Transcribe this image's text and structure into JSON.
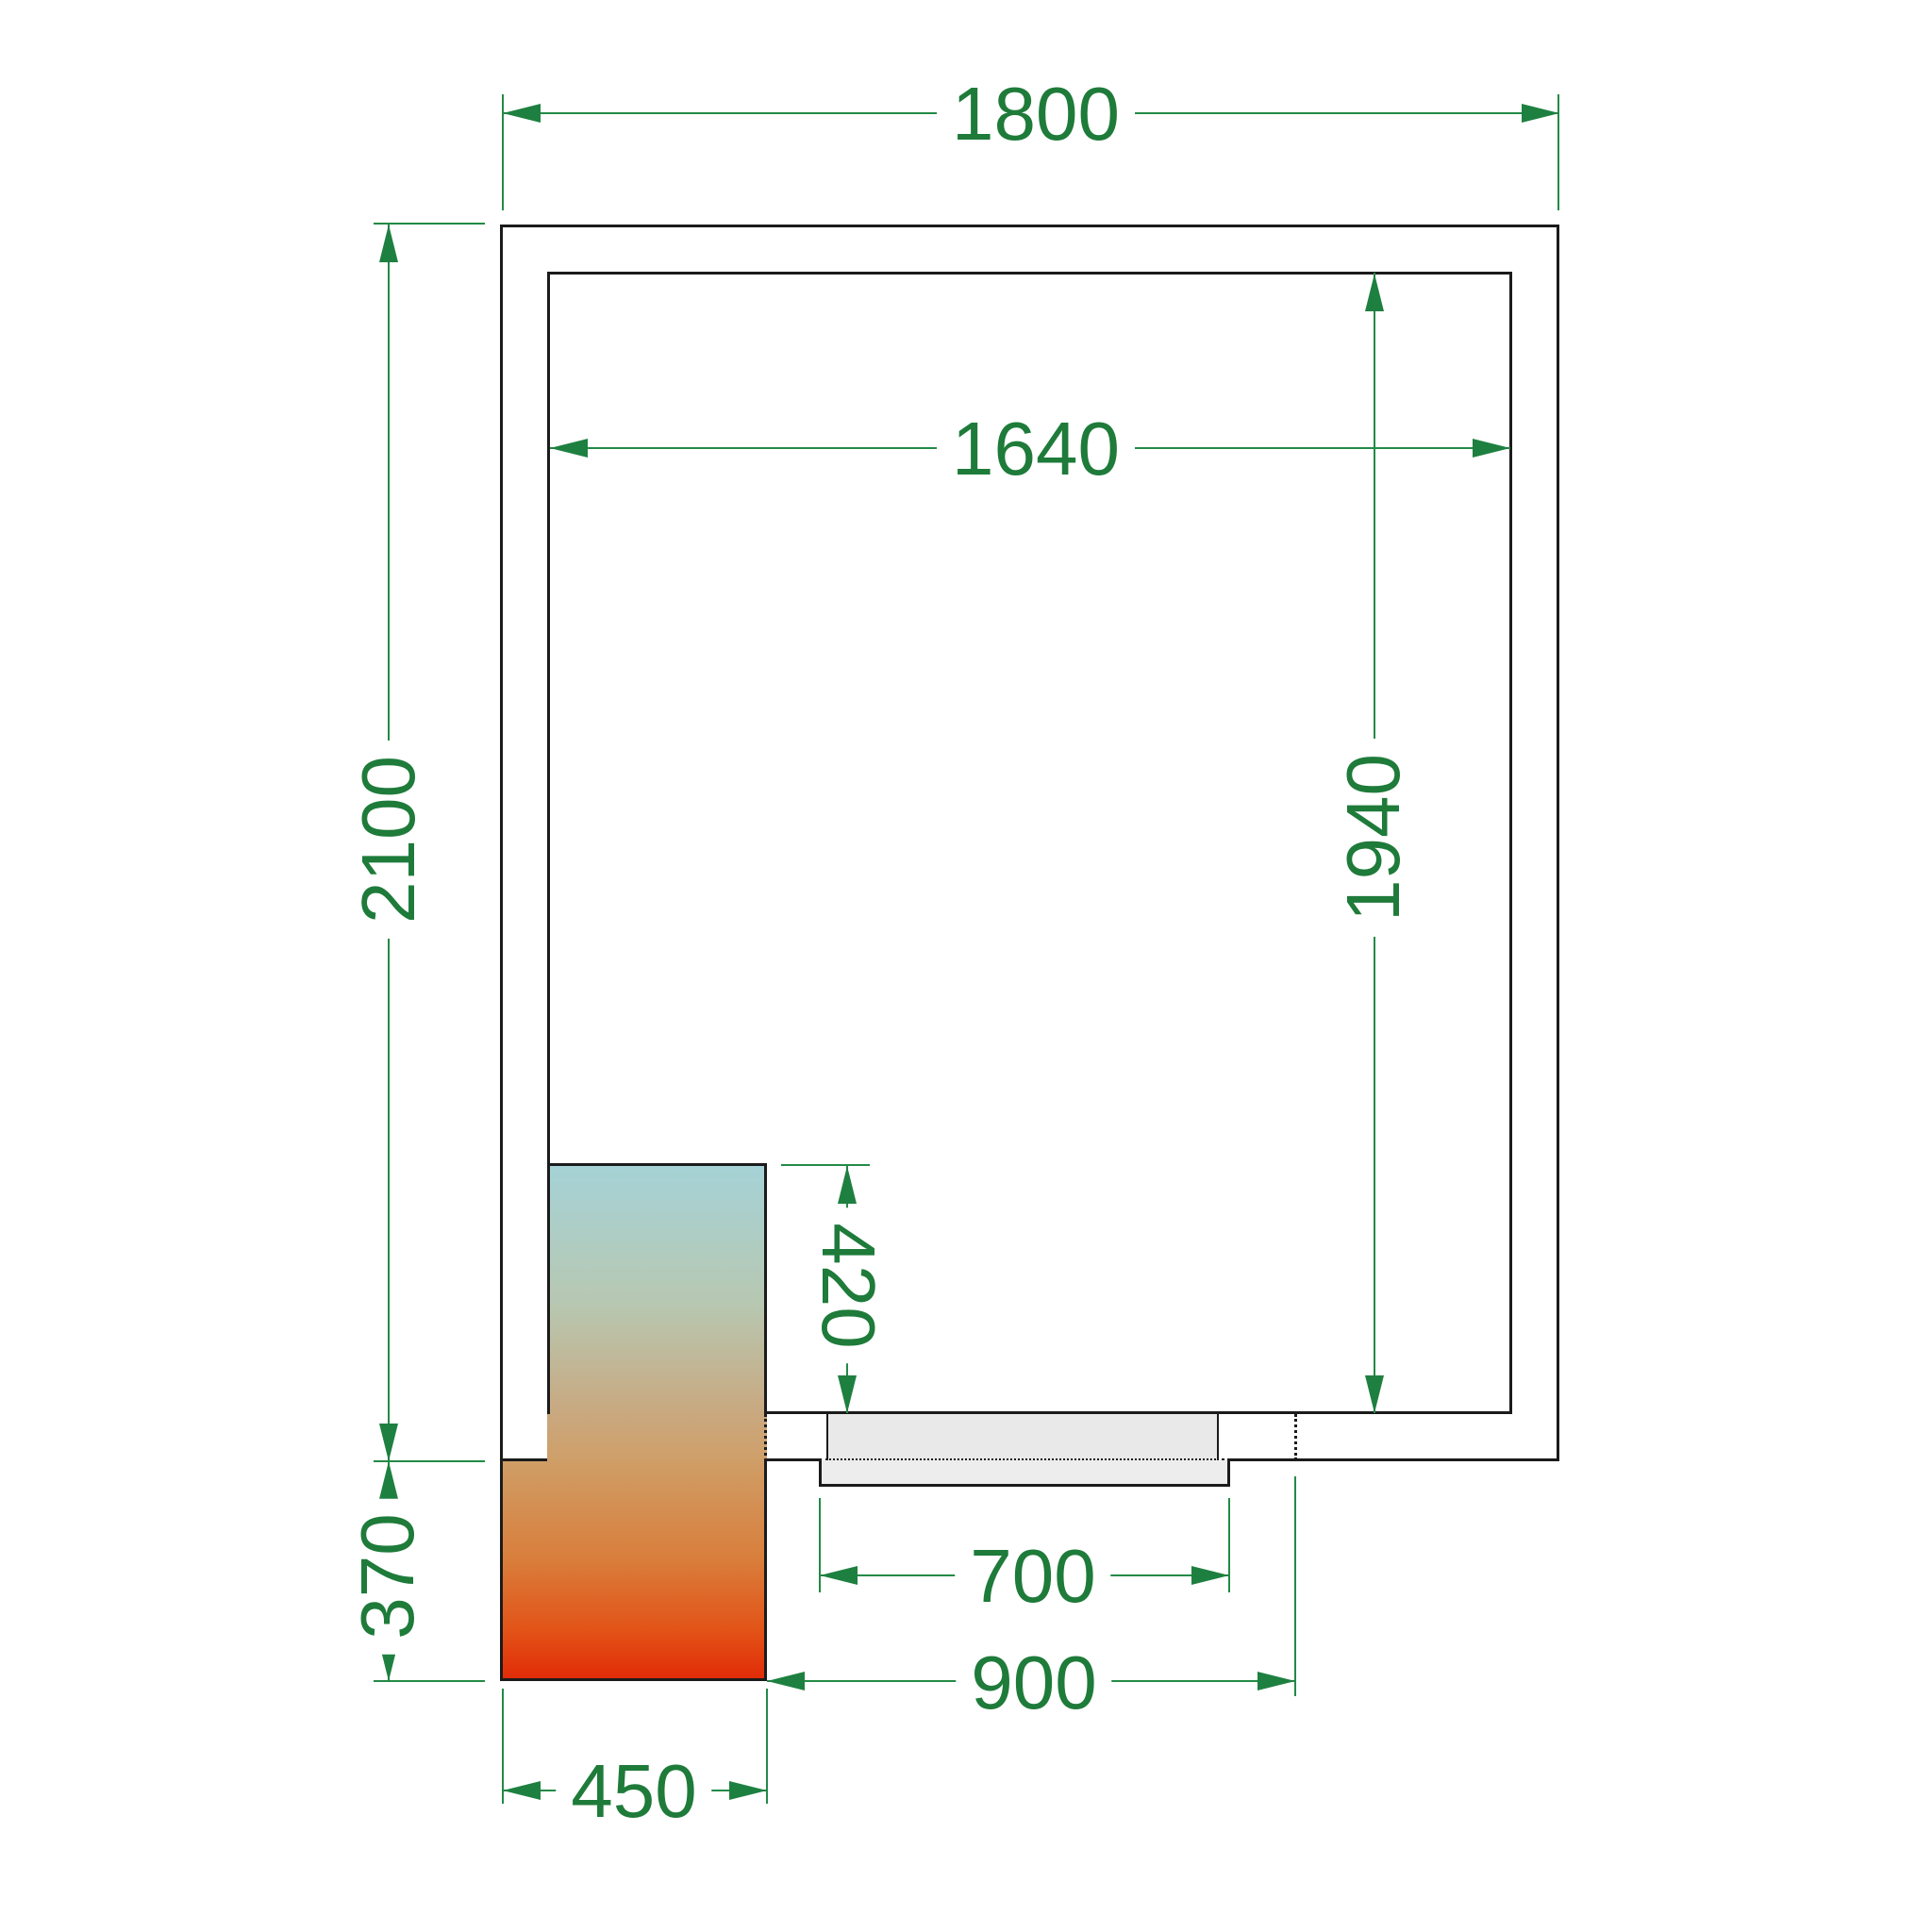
{
  "drawing": {
    "title": "Cold room floor plan with refrigeration unit and door",
    "labels": {
      "outer_width": "1800",
      "inner_width": "1640",
      "outer_depth": "2100",
      "inner_depth": "1940",
      "unit_indoor_depth": "420",
      "unit_outdoor_depth": "370",
      "door_leaf_width": "700",
      "door_opening_width": "900",
      "unit_width": "450"
    },
    "colors": {
      "dimension_green": "#1e7b3a",
      "wall_black": "#1b1b1b",
      "door_gray": "#e9e9e9",
      "unit_gradient_top": "#a5d2d6",
      "unit_gradient_middle": "#c9a87f",
      "unit_gradient_bottom": "#e12c08",
      "background": "#ffffff"
    }
  }
}
